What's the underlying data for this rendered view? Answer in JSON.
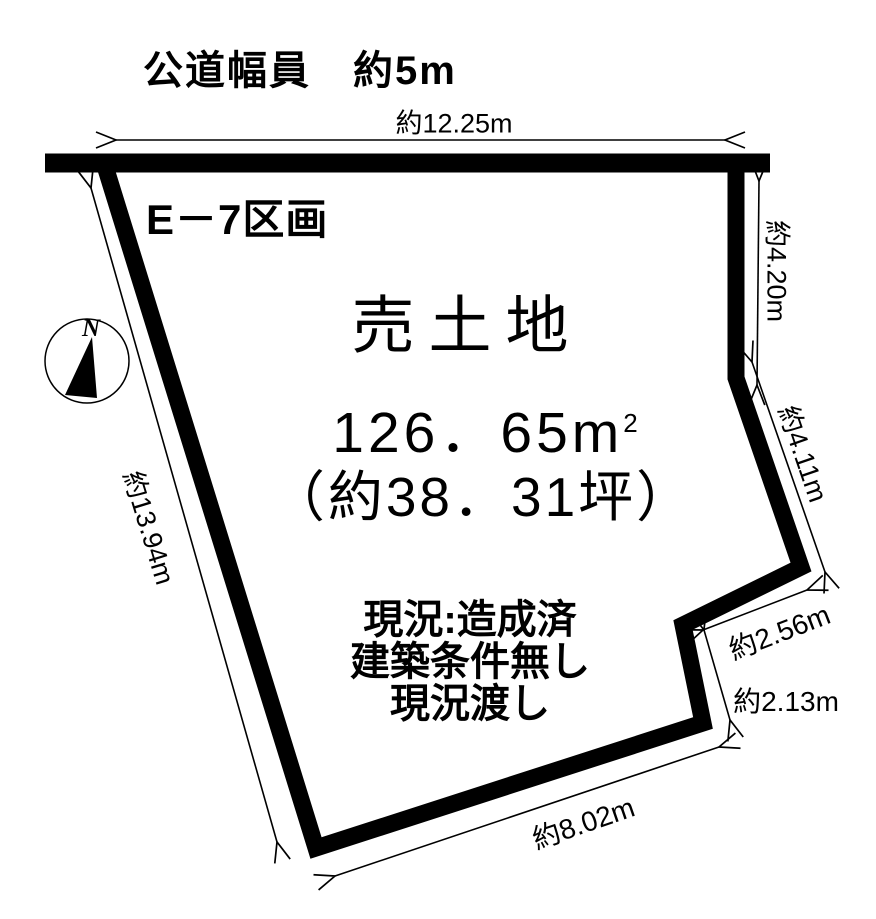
{
  "title": "公道幅員　約5m",
  "lot": {
    "name": "E－7区画",
    "sale_label": "売土地",
    "area_sqm": "126．65m",
    "area_sqm_sup": "2",
    "area_tsubo": "（約38．31坪）",
    "status_lines": [
      "現況:造成済",
      "建築条件無し",
      "現況渡し"
    ]
  },
  "dimensions": {
    "road_frontage": "約12.25m",
    "right_upper": "約4.20m",
    "right_diagonal": "約4.11m",
    "notch_upper": "約2.56m",
    "notch_lower": "約2.13m",
    "bottom": "約8.02m",
    "left": "約13.94m"
  },
  "compass": {
    "north": "N"
  },
  "colors": {
    "ink": "#000000",
    "background": "#ffffff"
  }
}
